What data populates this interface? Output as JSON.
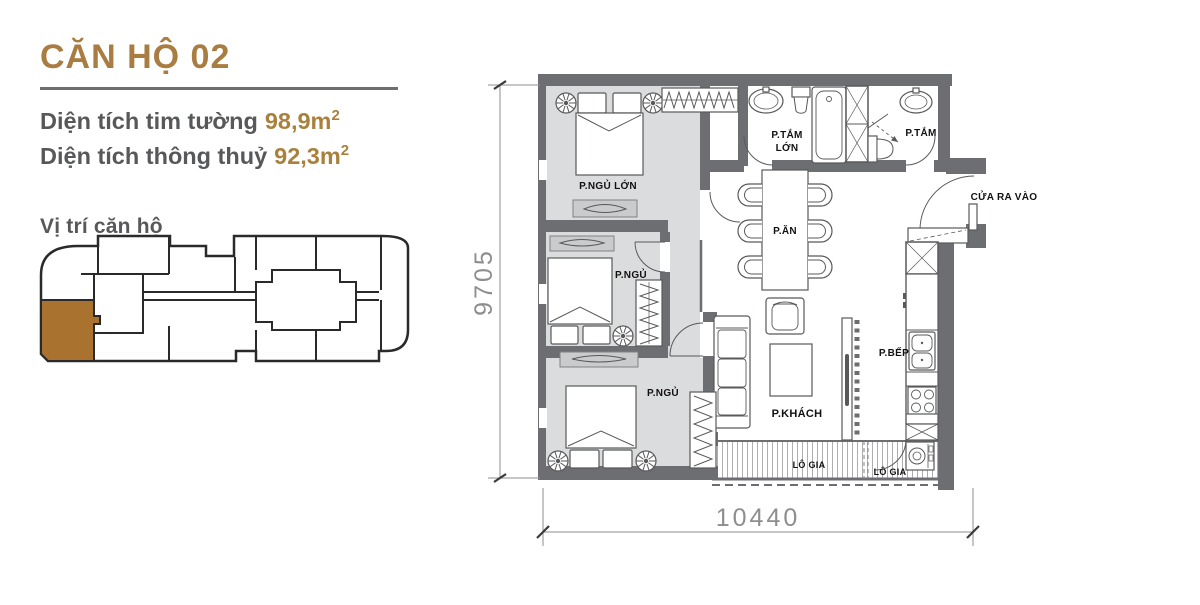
{
  "info_panel": {
    "title": "CĂN HỘ 02",
    "area_rows": [
      {
        "label": "Diện tích tim tường",
        "value": "98,9m",
        "sup": "2"
      },
      {
        "label": "Diện tích thông thuỷ",
        "value": "92,3m",
        "sup": "2"
      }
    ],
    "location_title": "Vị trí căn hộ"
  },
  "floor_plan": {
    "rooms": {
      "master_bedroom": "P.NGỦ LỚN",
      "big_bathroom_line1": "P.TẮM",
      "big_bathroom_line2": "LỚN",
      "bathroom": "P.TẮM",
      "dining": "P.ĂN",
      "entrance": "CỬA RA VÀO",
      "bedroom_2": "P.NGỦ",
      "bedroom_3": "P.NGỦ",
      "living": "P.KHÁCH",
      "kitchen": "P.BẾP",
      "loggia_main": "LÔ GIA",
      "loggia_small": "LÔ GIA"
    },
    "dimensions": {
      "horizontal": "10440",
      "vertical": "9705"
    }
  },
  "colors": {
    "accent_gold": "#A97C42",
    "value_gold": "#A9813C",
    "text_gray": "#57585A",
    "wall_gray": "#6D6E71",
    "room_fill_gray": "#DBDCDD",
    "console_gray": "#C9CBCC",
    "unit_highlight_brown": "#A9722F",
    "dimension_gray": "#8E8E8E"
  }
}
